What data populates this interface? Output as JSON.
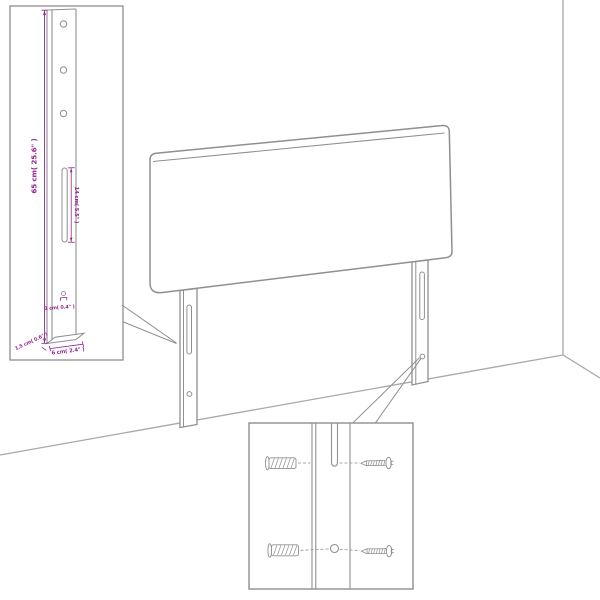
{
  "window": {
    "width": 600,
    "height": 600,
    "background": "#ffffff"
  },
  "diagram": {
    "type": "product-dimension-diagram",
    "subject": "upholstered headboard with two wall-mount legs shown in a room corner",
    "colors": {
      "outline": "#8f8f8f",
      "room_lines": "#a8a8a8",
      "dimension": "#93278F",
      "background": "#ffffff"
    },
    "labels": {
      "height": "65 cm( 25.6\" )",
      "slot_length": "14 cm( 5.5\" )",
      "hole_diameter": "1 cm( 0.4\" )",
      "leg_thickness": "1.5 cm( 0.6\" )",
      "leg_width": "6 cm( 2.4\" )"
    },
    "parts": {
      "headboard": "headboard panel",
      "left_leg": "left mounting leg with slot and hole",
      "right_leg": "right mounting leg with slot and hole",
      "leg_inset": "enlarged leg detail with three holes, long slot and bottom hole",
      "mount_inset": "mounting close-up with wall plugs and screws for slot and hole"
    }
  }
}
